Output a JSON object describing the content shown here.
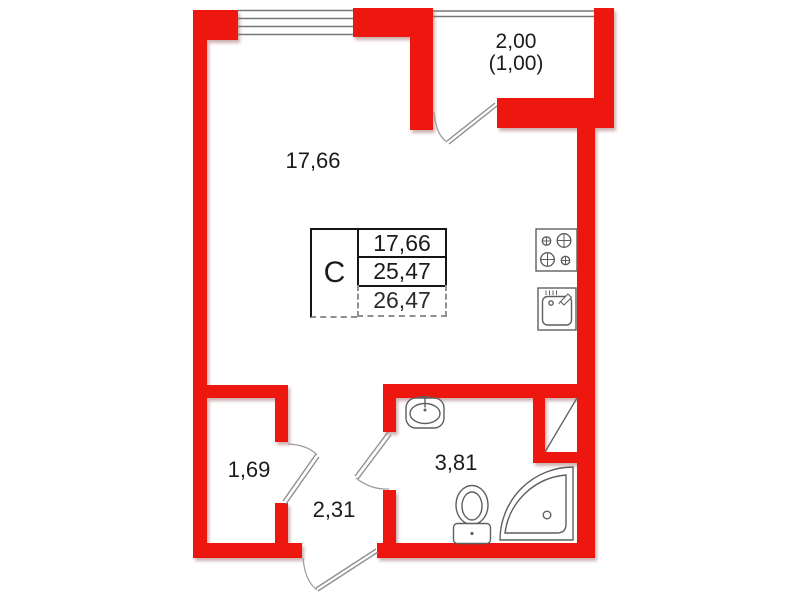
{
  "plan": {
    "kind": "studio-apartment-floor-plan",
    "colors": {
      "wall": "#ed1710",
      "fixture_line": "#5f5f5f",
      "window_line": "#777777",
      "door_line": "#8f8f8f",
      "text": "#1b1b1b",
      "background": "#ffffff"
    },
    "rooms": {
      "living": {
        "area": "17,66"
      },
      "balcony": {
        "area": "2,00",
        "area_reduced": "(1,00)"
      },
      "closet": {
        "area": "1,69"
      },
      "hallway": {
        "area": "2,31"
      },
      "bathroom": {
        "area": "3,81"
      }
    },
    "legend_table": {
      "type_label": "С",
      "rows": [
        "17,66",
        "25,47",
        "26,47"
      ]
    },
    "icons": {
      "stove": "stove-icon",
      "kitchen_sink": "kitchen-sink-icon",
      "washbasin": "washbasin-icon",
      "toilet": "toilet-icon",
      "shower": "shower-cabin-icon",
      "vent_shaft": "vent-shaft-icon",
      "windows": "window-icon",
      "doors": "door-icon"
    }
  }
}
